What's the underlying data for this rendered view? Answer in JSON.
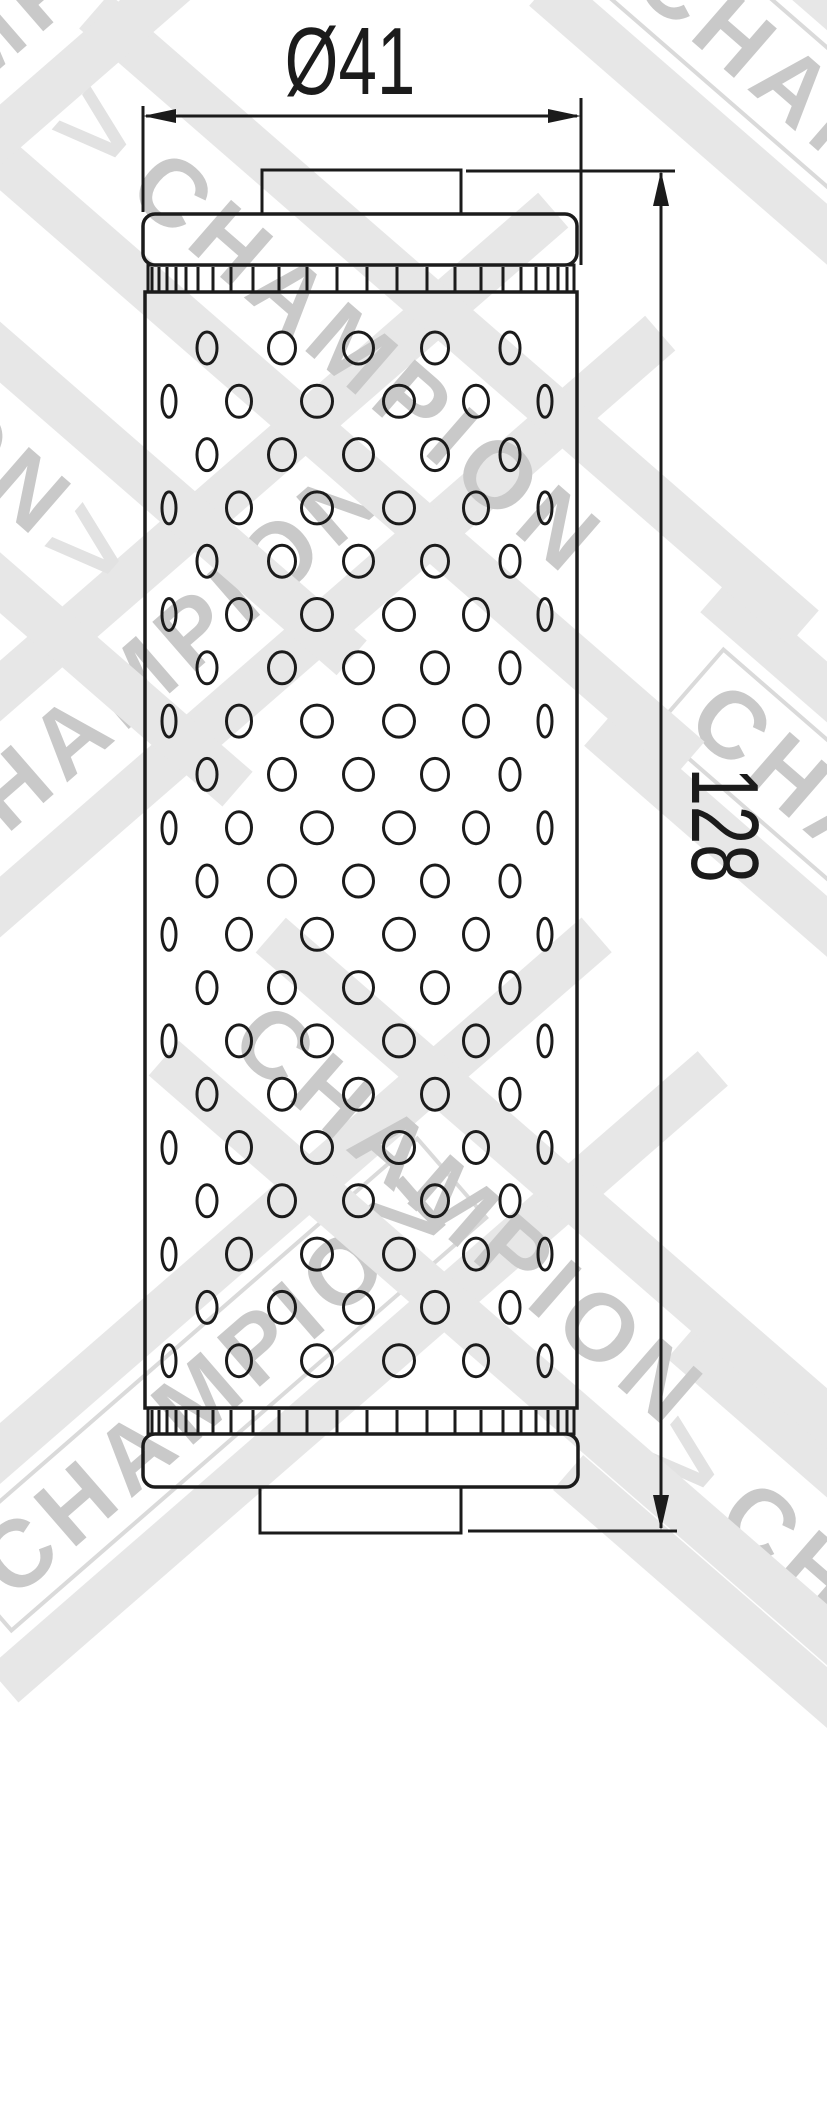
{
  "page": {
    "width": 827,
    "height": 1600,
    "background": "#ffffff"
  },
  "watermark": {
    "text": "CHAMPION",
    "chevron": ">",
    "letter_color": "#c9c9c9",
    "band_color": "#e7e7e7",
    "box_border_color": "#dadada"
  },
  "drawing": {
    "type": "technical-drawing",
    "subject": "cylindrical oil filter element, front view, perforated shell",
    "line_color": "#1b1b1b",
    "dimensions": [
      {
        "id": "diameter",
        "label": "Ø41",
        "orientation": "horizontal"
      },
      {
        "id": "height",
        "label": "128",
        "orientation": "vertical"
      }
    ],
    "perforation": {
      "rows": 20,
      "row_start_y": 348,
      "row_spacing": 53.3,
      "hole_ry": 16,
      "hole_stroke": 3,
      "row_type_a": [
        {
          "x": 207,
          "rx": 10
        },
        {
          "x": 282,
          "rx": 13.5
        },
        {
          "x": 358.5,
          "rx": 15
        },
        {
          "x": 435,
          "rx": 13.5
        },
        {
          "x": 510,
          "rx": 10
        }
      ],
      "row_type_b": [
        {
          "x": 169,
          "rx": 7
        },
        {
          "x": 239,
          "rx": 12.5
        },
        {
          "x": 317,
          "rx": 15.5
        },
        {
          "x": 399,
          "rx": 15.5
        },
        {
          "x": 476,
          "rx": 12.5
        },
        {
          "x": 545,
          "rx": 7
        }
      ]
    },
    "ribs": {
      "x0": 152,
      "x1": 571,
      "stroke": 3,
      "gap_pattern": [
        7,
        8,
        9,
        10,
        12,
        15,
        18,
        22,
        26,
        28,
        30,
        30,
        30,
        30,
        28,
        26,
        22,
        18,
        15,
        12,
        10,
        9,
        8,
        7
      ],
      "top_band": {
        "y0": 267,
        "y1": 291
      },
      "bottom_band": {
        "y0": 1410,
        "y1": 1433
      }
    }
  }
}
